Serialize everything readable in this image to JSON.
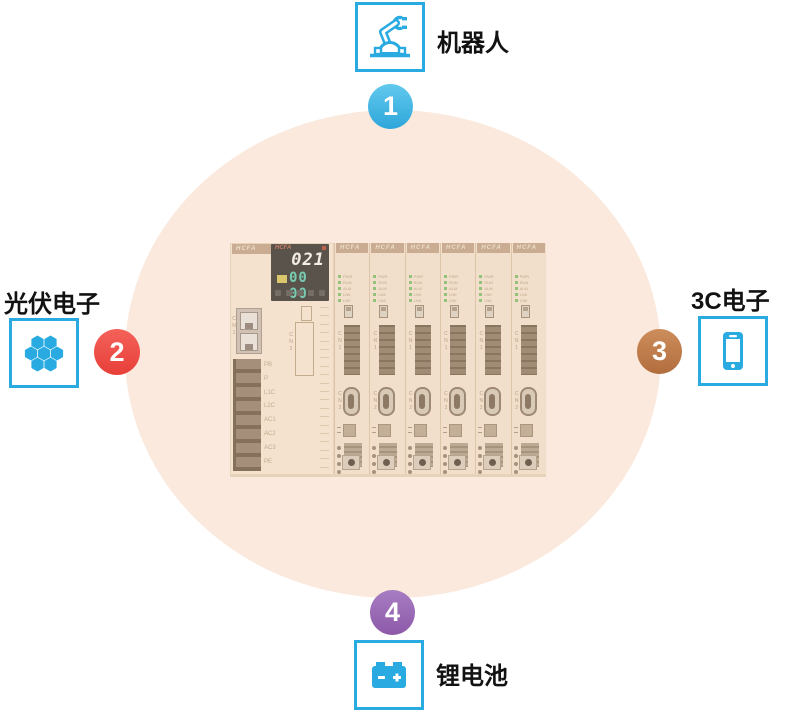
{
  "colors": {
    "accent_blue": "#29abe2",
    "circle_fill": "#fae9dc",
    "label_text": "#121212",
    "badge_blue": "#3fb4e3",
    "badge_red": "#ee4b43",
    "badge_brown": "#c07d4b",
    "badge_purple": "#9a68b4"
  },
  "nodes": {
    "robot": {
      "label": "机器人",
      "number": "1",
      "icon": "robot-arm-icon",
      "badge_gradient": [
        "#62c9ee",
        "#2ea6da"
      ]
    },
    "photovoltaic": {
      "label": "光伏电子",
      "number": "2",
      "icon": "solar-cell-icon",
      "badge_gradient": [
        "#f4625a",
        "#e73f38"
      ]
    },
    "electronics_3c": {
      "label": "3C电子",
      "number": "3",
      "icon": "smartphone-icon",
      "badge_gradient": [
        "#cd8d5c",
        "#b26d3d"
      ]
    },
    "lithium_battery": {
      "label": "锂电池",
      "number": "4",
      "icon": "battery-icon",
      "badge_gradient": [
        "#a77dc2",
        "#8d59a9"
      ]
    }
  },
  "device": {
    "brand": "HCFA",
    "display": {
      "value_top": "021",
      "value_bottom": "00 00"
    },
    "plc_port_label": "CN1",
    "plc_connector_label": "CN2",
    "terminal_labels": [
      "PB",
      "P",
      "L1C",
      "L2C",
      "AC1",
      "AC2",
      "AC3",
      "PE"
    ],
    "module_count": 6,
    "module_led_labels": [
      "PWR",
      "RUN",
      "ALM",
      "LNK",
      "LNK"
    ],
    "module_connector_labels": [
      "CN1",
      "CN2"
    ]
  }
}
